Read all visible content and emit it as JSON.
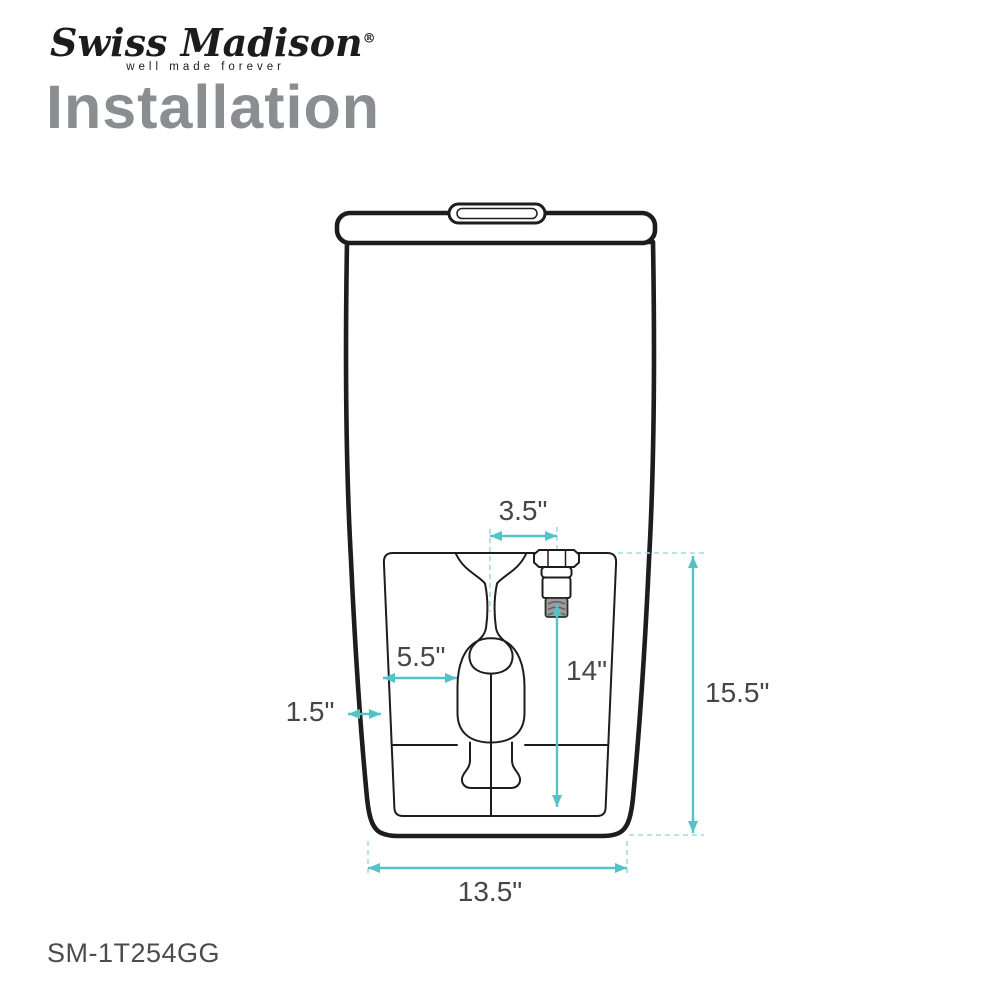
{
  "brand": {
    "name": "Swiss Madison",
    "registered_mark": "®",
    "tagline": "well made forever"
  },
  "page": {
    "title": "Installation"
  },
  "product": {
    "model_number": "SM-1T254GG"
  },
  "diagram": {
    "description": "Toilet rear-view line drawing with installation dimensions",
    "dimensions": {
      "supply_offset_from_center": "3.5\"",
      "recess_inset_left": "5.5\"",
      "side_wall_gap": "1.5\"",
      "supply_height": "14\"",
      "rear_recess_height": "15.5\"",
      "base_width": "13.5\""
    },
    "colors": {
      "dimension_line": "#54c3c8",
      "extension_line": "#9fdce0",
      "outline": "#1d1d1d",
      "title_gray": "#8a8e91"
    }
  }
}
